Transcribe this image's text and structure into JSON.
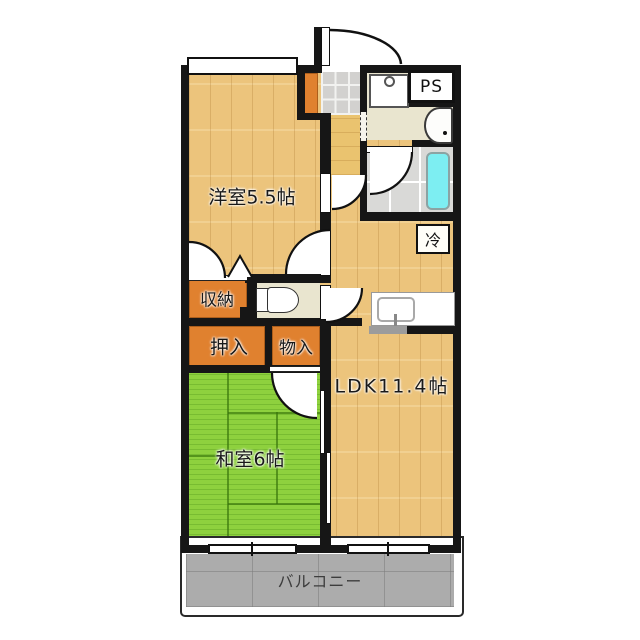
{
  "diagram_type": "apartment-floor-plan",
  "labels": {
    "western_room": "洋室5.5帖",
    "japanese_room": "和室6帖",
    "ldk": "LDK11.4帖",
    "closet_shuno": "収納",
    "closet_oshiire": "押入",
    "closet_monoire": "物入",
    "pipe_space": "PS",
    "refrigerator_space": "冷",
    "balcony": "バルコニー"
  },
  "fixtures": {
    "entrance_door": "entrance-swing-door",
    "shoe_cabinet": "shoe-cabinet",
    "genkan": "tiled-entrance",
    "washing_machine_pan": "washing-machine-pan",
    "wash_basin": "wash-basin",
    "bathtub": "bathtub",
    "toilet": "toilet",
    "kitchen_sink": "kitchen-sink-counter",
    "tatami_mats": 6,
    "balcony_windows": 2
  },
  "colors": {
    "wood_floor": "#ecc47c",
    "tatami": "#8ed13e",
    "closet_orange": "#e0812f",
    "bathtub_cyan": "#7deef2",
    "wall": "#161616",
    "balcony_concrete": "#acacac",
    "service_room_beige": "#e9e5cf"
  }
}
